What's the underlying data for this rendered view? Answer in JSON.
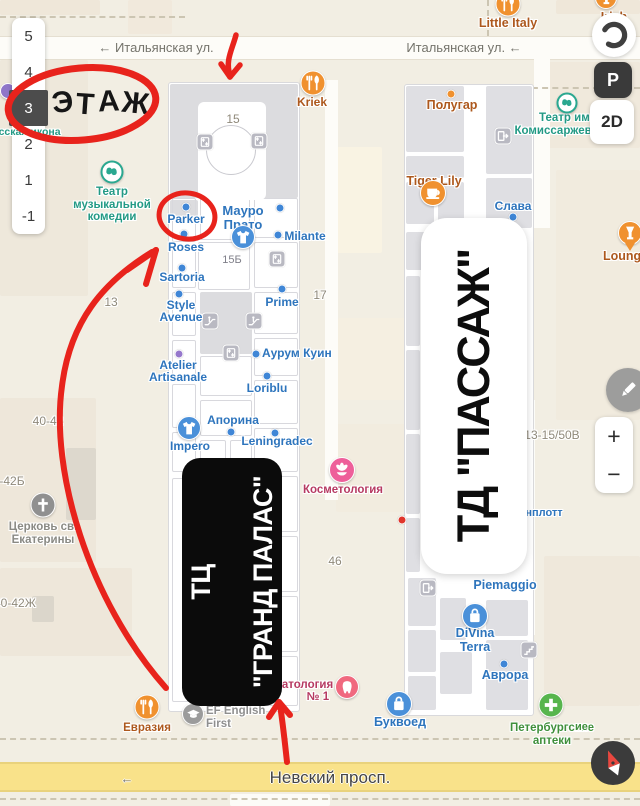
{
  "floor_panel": {
    "levels": [
      "5",
      "4",
      "3",
      "2",
      "1",
      "-1"
    ],
    "selected": "3"
  },
  "map_controls": {
    "mode": "2D",
    "parking": "P",
    "zoom_in": "+",
    "zoom_out": "−",
    "icons": [
      "layers-icon",
      "parking-icon",
      "mode-2d-button",
      "edit-pencil-icon",
      "zoom-in",
      "zoom-out",
      "compass-icon"
    ]
  },
  "annotation": {
    "floor_word": "ЭТАЖ",
    "color": "#e8231c"
  },
  "cards": {
    "grand_palace": {
      "lines": [
        "ТЦ",
        "\"ГРАНД ПАЛАС\""
      ]
    },
    "passage": {
      "text": "ТД \"ПАССАЖ\""
    }
  },
  "streets": [
    {
      "id": "italyanskaya-left",
      "name": "Итальянская ул.",
      "x": 156,
      "y": 40,
      "arrow": "before"
    },
    {
      "id": "italyanskaya-right",
      "name": "Итальянская ул.",
      "x": 464,
      "y": 40,
      "arrow": "after"
    },
    {
      "id": "nevsky",
      "name": "Невский просп.",
      "x": 330,
      "y": 768,
      "major": true
    },
    {
      "id": "nevsky-arrow",
      "name": "←",
      "x": 127,
      "y": 771
    }
  ],
  "labels": [
    {
      "id": "parker",
      "t": "Parker",
      "x": 186,
      "y": 213,
      "c": "blue"
    },
    {
      "id": "roses",
      "t": "Roses",
      "x": 186,
      "y": 241,
      "c": "blue"
    },
    {
      "id": "sartoria",
      "t": "Sartoria",
      "x": 182,
      "y": 271,
      "c": "blue"
    },
    {
      "id": "style-avenue",
      "t": "Style\nAvenue",
      "x": 181,
      "y": 299,
      "c": "blue"
    },
    {
      "id": "mauro-prato",
      "t": "Мауро\nПрато",
      "x": 243,
      "y": 204,
      "c": "blue",
      "s": 13
    },
    {
      "id": "milante",
      "t": "Milante",
      "x": 305,
      "y": 230,
      "c": "blue"
    },
    {
      "id": "prime",
      "t": "Prime",
      "x": 282,
      "y": 296,
      "c": "blue"
    },
    {
      "id": "aurum-kuin",
      "t": "Аурум Куин",
      "x": 262,
      "y": 347,
      "c": "blue",
      "align": "l"
    },
    {
      "id": "loriblu",
      "t": "Loriblu",
      "x": 267,
      "y": 382,
      "c": "blue"
    },
    {
      "id": "atelier-artisanale",
      "t": "Atelier\nArtisanale",
      "x": 178,
      "y": 359,
      "c": "blue"
    },
    {
      "id": "aporina",
      "t": "Апорина",
      "x": 233,
      "y": 414,
      "c": "blue"
    },
    {
      "id": "leningradec",
      "t": "Leningradec",
      "x": 277,
      "y": 435,
      "c": "blue"
    },
    {
      "id": "impero",
      "t": "Impero",
      "x": 190,
      "y": 440,
      "c": "blue"
    },
    {
      "id": "slava",
      "t": "Слава",
      "x": 513,
      "y": 200,
      "c": "blue"
    },
    {
      "id": "room-15b",
      "t": "15Б",
      "x": 232,
      "y": 254,
      "c": "room"
    },
    {
      "id": "kosmetologia",
      "t": "Косметология",
      "x": 343,
      "y": 484,
      "c": "pink",
      "s": 11.5
    },
    {
      "id": "stomatologia",
      "t": "Стоматология",
      "x": 293,
      "y": 679,
      "c": "pink",
      "s": 11.5
    },
    {
      "id": "stomatologia-no",
      "t": "№ 1",
      "x": 318,
      "y": 691,
      "c": "pink",
      "s": 11.5
    },
    {
      "id": "piemaggio",
      "t": "Piemaggio",
      "x": 505,
      "y": 579,
      "c": "blue",
      "s": 12.5
    },
    {
      "id": "divina-terra",
      "t": "DiVina\nTerra",
      "x": 475,
      "y": 627,
      "c": "blue",
      "s": 12.5
    },
    {
      "id": "avrora",
      "t": "Аврора",
      "x": 505,
      "y": 669,
      "c": "blue",
      "s": 12.5
    },
    {
      "id": "bukvoed",
      "t": "Буквоед",
      "x": 400,
      "y": 716,
      "c": "blue",
      "s": 12.5
    },
    {
      "id": "peterburgskie-apteki",
      "t": "Петербургские\nаптеки",
      "x": 552,
      "y": 722,
      "c": "green",
      "s": 11.5
    },
    {
      "id": "evrazia",
      "t": "Евразия",
      "x": 147,
      "y": 722,
      "c": "orangetext",
      "s": 11.5
    },
    {
      "id": "ef-english-first",
      "t": "EF English\nFirst",
      "x": 206,
      "y": 705,
      "c": "gray",
      "s": 11.5,
      "align": "l"
    },
    {
      "id": "tiger-lily",
      "t": "Tiger Lily",
      "x": 434,
      "y": 175,
      "c": "orangetext",
      "s": 12.5
    },
    {
      "id": "polugar",
      "t": "Полугар",
      "x": 452,
      "y": 99,
      "c": "orangetext",
      "s": 12.5
    },
    {
      "id": "kriek",
      "t": "Kriek",
      "x": 312,
      "y": 96,
      "c": "orangetext"
    },
    {
      "id": "little-italy",
      "t": "Little Italy",
      "x": 508,
      "y": 17,
      "c": "orangetext",
      "s": 12.5
    },
    {
      "id": "irish-house",
      "t": "Irish House",
      "x": 614,
      "y": 11,
      "c": "orangetext",
      "s": 12.5
    },
    {
      "id": "lounger",
      "t": "LoungeR",
      "x": 603,
      "y": 250,
      "c": "orangetext",
      "s": 12.5,
      "align": "l"
    },
    {
      "id": "teatr-komissarzhevskoy",
      "t": "Театр им.\nКомиссаржевской",
      "x": 566,
      "y": 112,
      "c": "teal",
      "s": 11.5
    },
    {
      "id": "teatr-muz-komedii",
      "t": "Театр\nмузыкальной\nкомедии",
      "x": 112,
      "y": 186,
      "c": "teal",
      "s": 11.5
    },
    {
      "id": "tserkov-ekateriny",
      "t": "Церковь св.\nЕкатерины",
      "x": 43,
      "y": 521,
      "c": "gray2",
      "s": 11.5
    },
    {
      "id": "russkaya-ikona",
      "t": "Русская икона",
      "x": -14,
      "y": 127,
      "c": "teal",
      "s": 10.5,
      "align": "l",
      "z": 41
    },
    {
      "id": "shenplott-fragment",
      "t": "нплотт",
      "x": 544,
      "y": 507,
      "c": "blue",
      "s": 11
    },
    {
      "id": "green-fragment",
      "t": "ие",
      "x": 575,
      "y": 721,
      "c": "green",
      "s": 11,
      "align": "l"
    },
    {
      "id": "bld-15",
      "t": "15",
      "x": 233,
      "y": 113,
      "c": "bnum"
    },
    {
      "id": "bld-17",
      "t": "17",
      "x": 320,
      "y": 289,
      "c": "bnum"
    },
    {
      "id": "bld-46",
      "t": "46",
      "x": 335,
      "y": 555,
      "c": "bnum"
    },
    {
      "id": "bld-13",
      "t": "13",
      "x": 111,
      "y": 296,
      "c": "bnum"
    },
    {
      "id": "bld-40-42",
      "t": "40-42",
      "x": 48,
      "y": 415,
      "c": "bnum"
    },
    {
      "id": "bld-40-42b",
      "t": "40-42Б",
      "x": -14,
      "y": 475,
      "c": "bnum",
      "align": "l"
    },
    {
      "id": "bld-40-42zh",
      "t": "40-42Ж",
      "x": -6,
      "y": 597,
      "c": "bnum",
      "align": "l"
    },
    {
      "id": "bld-13-15-50v",
      "t": "13-15/50В",
      "x": 552,
      "y": 429,
      "c": "bnum"
    }
  ],
  "dots": [
    {
      "id": "parker-dot",
      "x": 186,
      "y": 207,
      "c": "blue"
    },
    {
      "id": "roses-dot",
      "x": 184,
      "y": 234,
      "c": "blue"
    },
    {
      "id": "sartoria-dot",
      "x": 182,
      "y": 268,
      "c": "blue"
    },
    {
      "id": "style-avenue-dot",
      "x": 179,
      "y": 294,
      "c": "blue"
    },
    {
      "id": "shop-dot",
      "x": 280,
      "y": 208,
      "c": "blue"
    },
    {
      "id": "milante-dot",
      "x": 278,
      "y": 235,
      "c": "blue"
    },
    {
      "id": "prime-dot",
      "x": 282,
      "y": 289,
      "c": "blue"
    },
    {
      "id": "aurum-dot",
      "x": 256,
      "y": 354,
      "c": "blue"
    },
    {
      "id": "loriblu-dot",
      "x": 267,
      "y": 376,
      "c": "blue"
    },
    {
      "id": "atelier-dot",
      "x": 179,
      "y": 354,
      "c": "purple"
    },
    {
      "id": "aporina-dot",
      "x": 231,
      "y": 432,
      "c": "blue"
    },
    {
      "id": "leningradec-dot",
      "x": 275,
      "y": 433,
      "c": "blue"
    },
    {
      "id": "slava-dot",
      "x": 513,
      "y": 217,
      "c": "blue"
    },
    {
      "id": "polugar-dot",
      "x": 451,
      "y": 94,
      "c": "orange"
    },
    {
      "id": "avrora-dot",
      "x": 504,
      "y": 664,
      "c": "blue"
    },
    {
      "id": "red-poi-dot",
      "x": 402,
      "y": 520,
      "c": "red"
    }
  ],
  "icons": [
    {
      "id": "mauro-prato-icon",
      "n": "tshirt",
      "x": 243,
      "y": 237,
      "bg": "#4a90d9",
      "d": 24
    },
    {
      "id": "impero-icon",
      "n": "tshirt",
      "x": 189,
      "y": 428,
      "bg": "#4a90d9",
      "d": 24
    },
    {
      "id": "divina-terra-icon",
      "n": "bag",
      "x": 475,
      "y": 616,
      "bg": "#4a90d9",
      "d": 26
    },
    {
      "id": "bukvoed-icon",
      "n": "bag",
      "x": 399,
      "y": 704,
      "bg": "#4a90d9",
      "d": 26
    },
    {
      "id": "kosmetologia-icon",
      "n": "flower",
      "x": 342,
      "y": 470,
      "bg": "#ee5f9a",
      "d": 26
    },
    {
      "id": "stomatologia-icon",
      "n": "tooth",
      "x": 347,
      "y": 687,
      "bg": "#f0697f",
      "d": 24
    },
    {
      "id": "apteki-icon",
      "n": "plus",
      "x": 551,
      "y": 705,
      "bg": "#57b54d",
      "d": 25
    },
    {
      "id": "kriek-icon",
      "n": "food",
      "x": 313,
      "y": 83,
      "bg": "#f0912f",
      "d": 25
    },
    {
      "id": "little-italy-icon",
      "n": "food",
      "x": 508,
      "y": 4,
      "bg": "#f0912f",
      "d": 25
    },
    {
      "id": "evrazia-icon",
      "n": "food",
      "x": 147,
      "y": 707,
      "bg": "#f0912f",
      "d": 25
    },
    {
      "id": "tiger-lily-icon",
      "n": "cup",
      "x": 433,
      "y": 193,
      "bg": "#f0912f",
      "d": 26
    },
    {
      "id": "irish-house-icon",
      "n": "wine",
      "x": 606,
      "y": -2,
      "bg": "#f0912f",
      "d": 22
    },
    {
      "id": "lounger-icon",
      "n": "wine",
      "x": 630,
      "y": 233,
      "bg": "#f0912f",
      "d": 24,
      "pin": true
    },
    {
      "id": "teatr-kom-icon",
      "n": "theater",
      "x": 567,
      "y": 103,
      "d": 21,
      "theater": true
    },
    {
      "id": "teatr-muz-icon",
      "n": "theater",
      "x": 112,
      "y": 172,
      "d": 23,
      "theater": true
    },
    {
      "id": "church-icon",
      "n": "cross",
      "x": 43,
      "y": 505,
      "bg": "#909090",
      "d": 25
    },
    {
      "id": "ef-icon",
      "n": "gradcap",
      "x": 193,
      "y": 714,
      "bg": "#9b9b9b",
      "d": 22
    },
    {
      "id": "poi-purple-icon",
      "n": "none",
      "x": 8,
      "y": 91,
      "bg": "#8f76c9",
      "d": 16
    },
    {
      "id": "elevator-icon",
      "n": "elevator",
      "x": 205,
      "y": 142,
      "sq": true
    },
    {
      "id": "elevator-icon",
      "n": "elevator",
      "x": 259,
      "y": 141,
      "sq": true
    },
    {
      "id": "elevator-icon",
      "n": "elevator",
      "x": 277,
      "y": 259,
      "sq": true
    },
    {
      "id": "elevator-icon",
      "n": "elevator",
      "x": 231,
      "y": 353,
      "sq": true
    },
    {
      "id": "escalator-icon",
      "n": "escalator",
      "x": 210,
      "y": 321,
      "sq": true
    },
    {
      "id": "escalator-icon",
      "n": "escalator",
      "x": 254,
      "y": 321,
      "sq": true
    },
    {
      "id": "stairs-icon",
      "n": "stairs",
      "x": 529,
      "y": 650,
      "sq": true
    },
    {
      "id": "exit-icon",
      "n": "exit",
      "x": 503,
      "y": 136,
      "sq": true
    },
    {
      "id": "exit-icon",
      "n": "exit",
      "x": 428,
      "y": 588,
      "sq": true
    }
  ],
  "geometry": {
    "blocks": [
      {
        "x": 0,
        "y": 0,
        "w": 100,
        "h": 15,
        "f": "#efe7d9"
      },
      {
        "x": 128,
        "y": 0,
        "w": 44,
        "h": 34,
        "f": "#f1e9dc"
      },
      {
        "x": 556,
        "y": 0,
        "w": 84,
        "h": 14,
        "f": "#efe7d9"
      },
      {
        "x": 0,
        "y": 60,
        "w": 88,
        "h": 236,
        "f": "#eee8db"
      },
      {
        "x": 544,
        "y": 62,
        "w": 96,
        "h": 86,
        "f": "#f0e9dc"
      },
      {
        "x": 556,
        "y": 170,
        "w": 84,
        "h": 250,
        "f": "#f1ebde"
      },
      {
        "x": 334,
        "y": 147,
        "w": 48,
        "h": 106,
        "f": "#f9f3e3"
      },
      {
        "x": 338,
        "y": 318,
        "w": 68,
        "h": 82,
        "f": "#f5efe1"
      },
      {
        "x": 336,
        "y": 424,
        "w": 70,
        "h": 88,
        "f": "#f2ecdf"
      },
      {
        "x": 0,
        "y": 398,
        "w": 96,
        "h": 164,
        "f": "#eee7da"
      },
      {
        "x": 66,
        "y": 448,
        "w": 30,
        "h": 72,
        "f": "#ddd8cd"
      },
      {
        "x": 0,
        "y": 568,
        "w": 132,
        "h": 88,
        "f": "#eee7da"
      },
      {
        "x": 32,
        "y": 596,
        "w": 22,
        "h": 26,
        "f": "#dbd6cb"
      },
      {
        "x": 544,
        "y": 556,
        "w": 96,
        "h": 150,
        "f": "#efe8db"
      },
      {
        "x": 230,
        "y": 794,
        "w": 100,
        "h": 12,
        "f": "#fcfbf7"
      }
    ],
    "roads": [
      {
        "x": 0,
        "y": 36,
        "w": 640,
        "h": 24,
        "h_road": true
      },
      {
        "x": 325,
        "y": 80,
        "w": 13,
        "h": 420
      },
      {
        "x": 520,
        "y": 400,
        "w": 15,
        "h": 235
      },
      {
        "x": 534,
        "y": 58,
        "w": 16,
        "h": 170
      }
    ],
    "dashes": [
      {
        "x": 0,
        "y": 16,
        "len": 185,
        "v": false
      },
      {
        "x": 440,
        "y": 87,
        "len": 200,
        "v": false
      },
      {
        "x": 0,
        "y": 738,
        "len": 640,
        "v": false
      },
      {
        "x": 487,
        "y": 0,
        "len": 36,
        "v": true
      },
      {
        "x": 0,
        "y": 798,
        "len": 640,
        "v": false
      }
    ],
    "mall": {
      "x": 168,
      "y": 82,
      "w": 132,
      "h": 630
    },
    "passage": {
      "x": 404,
      "y": 84,
      "w": 130,
      "h": 632
    },
    "mall_gray": [
      [
        170,
        84,
        128,
        114
      ],
      [
        200,
        292,
        52,
        62
      ],
      [
        170,
        200,
        28,
        16
      ]
    ],
    "rooms_mall": [
      [
        200,
        196,
        50,
        44
      ],
      [
        254,
        198,
        44,
        40
      ],
      [
        254,
        242,
        44,
        46
      ],
      [
        198,
        242,
        52,
        48
      ],
      [
        172,
        198,
        24,
        44
      ],
      [
        172,
        246,
        24,
        42
      ],
      [
        172,
        292,
        24,
        44
      ],
      [
        172,
        340,
        24,
        40
      ],
      [
        172,
        384,
        24,
        44
      ],
      [
        172,
        432,
        24,
        40
      ],
      [
        254,
        292,
        44,
        42
      ],
      [
        254,
        338,
        44,
        38
      ],
      [
        254,
        380,
        44,
        44
      ],
      [
        200,
        356,
        52,
        40
      ],
      [
        200,
        400,
        52,
        36
      ],
      [
        254,
        428,
        44,
        44
      ],
      [
        200,
        440,
        26,
        30
      ],
      [
        230,
        440,
        22,
        30
      ],
      [
        254,
        476,
        44,
        56
      ],
      [
        254,
        536,
        44,
        56
      ],
      [
        254,
        596,
        44,
        56
      ],
      [
        254,
        656,
        44,
        50
      ],
      [
        172,
        478,
        24,
        224
      ]
    ],
    "rooms_passage": [
      [
        406,
        86,
        58,
        66
      ],
      [
        406,
        156,
        58,
        22
      ],
      [
        406,
        182,
        28,
        42
      ],
      [
        438,
        182,
        26,
        42
      ],
      [
        486,
        86,
        46,
        88
      ],
      [
        486,
        178,
        46,
        50
      ],
      [
        406,
        232,
        26,
        38
      ],
      [
        436,
        232,
        28,
        38
      ],
      [
        406,
        276,
        14,
        70
      ],
      [
        406,
        350,
        14,
        80
      ],
      [
        406,
        434,
        14,
        80
      ],
      [
        406,
        518,
        14,
        54
      ],
      [
        408,
        578,
        28,
        48
      ],
      [
        408,
        630,
        28,
        42
      ],
      [
        408,
        676,
        28,
        34
      ],
      [
        440,
        598,
        26,
        42
      ],
      [
        440,
        652,
        32,
        42
      ],
      [
        486,
        600,
        42,
        36
      ],
      [
        486,
        640,
        42,
        32
      ],
      [
        486,
        676,
        42,
        34
      ]
    ]
  }
}
